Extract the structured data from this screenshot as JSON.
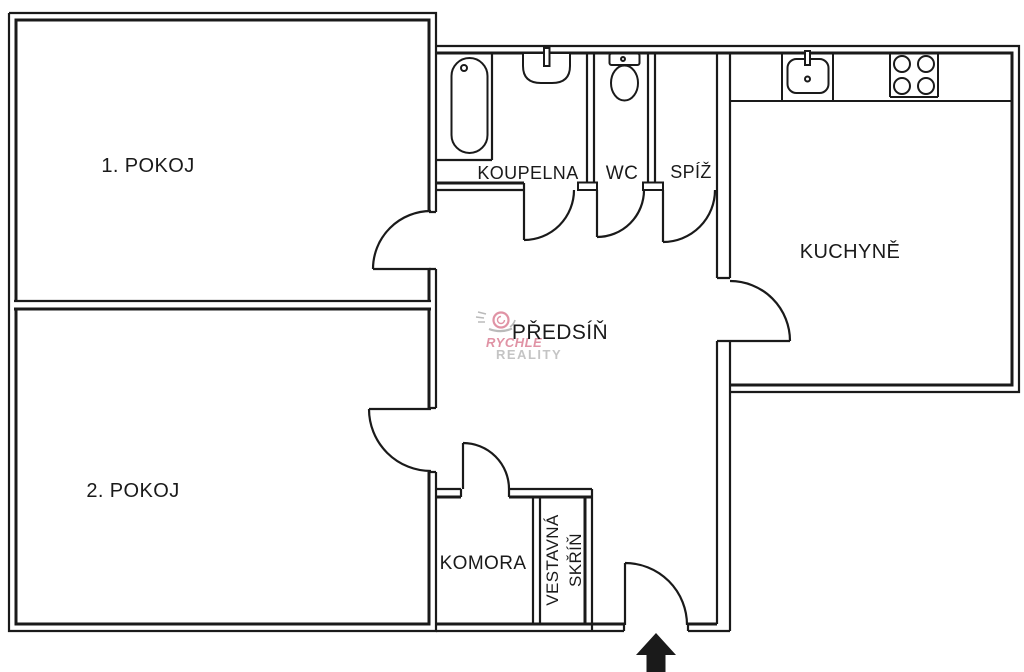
{
  "plan": {
    "labels": {
      "room1": "1. POKOJ",
      "room2": "2. POKOJ",
      "bathroom": "KOUPELNA",
      "wc": "WC",
      "pantry": "SPÍŽ",
      "kitchen": "KUCHYNĚ",
      "hallway": "PŘEDSÍŇ",
      "storage": "KOMORA",
      "wardrobe_line1": "VESTAVNÁ",
      "wardrobe_line2": "SKŘÍŇ"
    },
    "colors": {
      "wall": "#1a1a1a",
      "background": "#ffffff"
    }
  },
  "watermark": {
    "line1": "RYCHLE",
    "line2": "REALITY",
    "color_line1": "#d9798f",
    "color_line2": "#b6b6b6"
  }
}
